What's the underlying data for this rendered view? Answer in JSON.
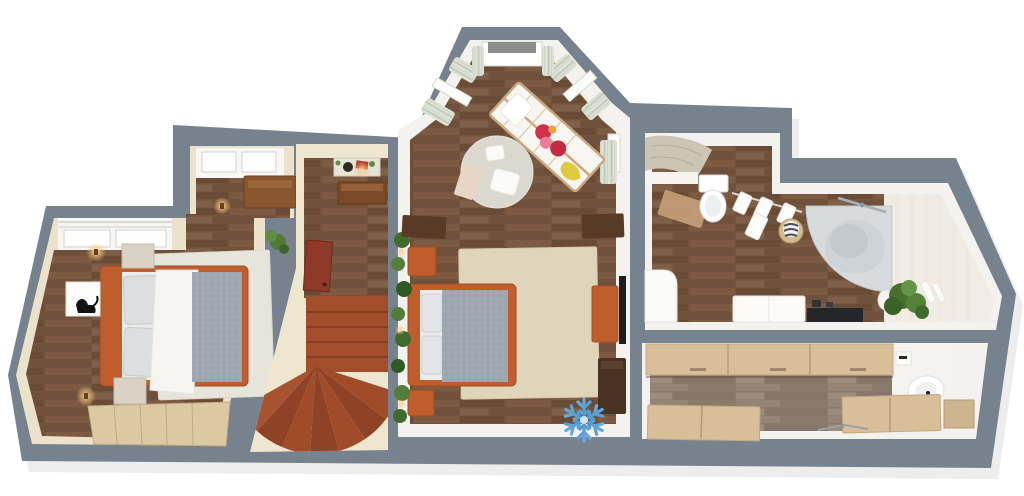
{
  "meta": {
    "description": "3D rendered top-down floor plan of an apartment upper floor",
    "canvas": {
      "width": 1024,
      "height": 496
    }
  },
  "palette": {
    "background": "#ffffff",
    "outer_wall": "#76828e",
    "inner_wall_face": "#f4f2ee",
    "cream_wall": "#ece2cc",
    "cream_floor": "#efe6d0",
    "wood_floor_mid": "#74543c",
    "kitchen_floor": "#8b7a6c",
    "stair_terracotta": "#a24e2c",
    "stair_terracotta_dark": "#8f4226",
    "door_red": "#8f3a28",
    "accent_orange": "#bf5e2c",
    "light_wood": "#d8bf9a",
    "wardrobe_wood": "#dcc9a4",
    "rug_white": "#e7e4db",
    "rug_beige": "#e0d5bb",
    "duvet_gray": "#9fa8b0",
    "bedding_white": "#f6f5f2",
    "tub_gray": "#d8dbdd",
    "plant_green": "#4e7a36",
    "curtain_sage": "#dde2d6",
    "glow_warm": "#f7c87e",
    "snowflake_blue_light": "#7fc4f2",
    "snowflake_blue_dark": "#1e62a6"
  },
  "rooms": [
    {
      "name": "bedroom-left",
      "floor": "dark-wood",
      "furniture": [
        "double-bed-orange-frame",
        "gray-knit-blanket",
        "white-duvet",
        "gray-pillows",
        "nightstand",
        "nightstand",
        "white-area-rug",
        "black-cat-wall-art",
        "wall-lamp",
        "wall-lamp",
        "wardrobe-light-wood",
        "window-band-with-curtain-rails",
        "window-nook",
        "wooden-bench",
        "potted-plant"
      ]
    },
    {
      "name": "stair-hall",
      "floor": "dark-wood-and-cream",
      "furniture": [
        "winder-staircase-terracotta",
        "open-door-red-brown",
        "console-shelf",
        "wall-art",
        "ceiling-lamp"
      ]
    },
    {
      "name": "nursery-bedroom",
      "floor": "dark-wood",
      "furniture": [
        "house-frame-crib",
        "hanging-clothes",
        "yellow-blanket",
        "round-rug",
        "floor-cushions",
        "double-bed-orange-frame",
        "nightstand",
        "nightstand",
        "large-beige-rug",
        "tall-plant-with-string-lights",
        "media-console",
        "wall-tv",
        "desk",
        "desk",
        "dark-shelf",
        "bay-windows-with-curtains",
        "roller-shade"
      ]
    },
    {
      "name": "bathroom",
      "floor": "dark-wood",
      "furniture": [
        "corner-bathtub",
        "bath-faucet",
        "wall-hung-toilet",
        "towel-rail-with-towels",
        "towel-basket",
        "vanity-cabinet",
        "dark-counter",
        "potted-plant",
        "shower-curtain",
        "white-pedestal",
        "hanging-robes",
        "beige-mat"
      ]
    },
    {
      "name": "kitchen-corridor",
      "floor": "gray-wood",
      "furniture": [
        "upper-cabinet-row-light-wood",
        "lower-cabinet-row-left",
        "lower-cabinet-row-right",
        "end-cabinet",
        "toilet",
        "cistern",
        "faucet"
      ]
    }
  ],
  "icons": [
    {
      "name": "snowflake-icon",
      "meaning": "cooling-marker",
      "colors": [
        "#7fc4f2",
        "#1e62a6"
      ],
      "center": {
        "x": 584,
        "y": 420
      }
    }
  ]
}
